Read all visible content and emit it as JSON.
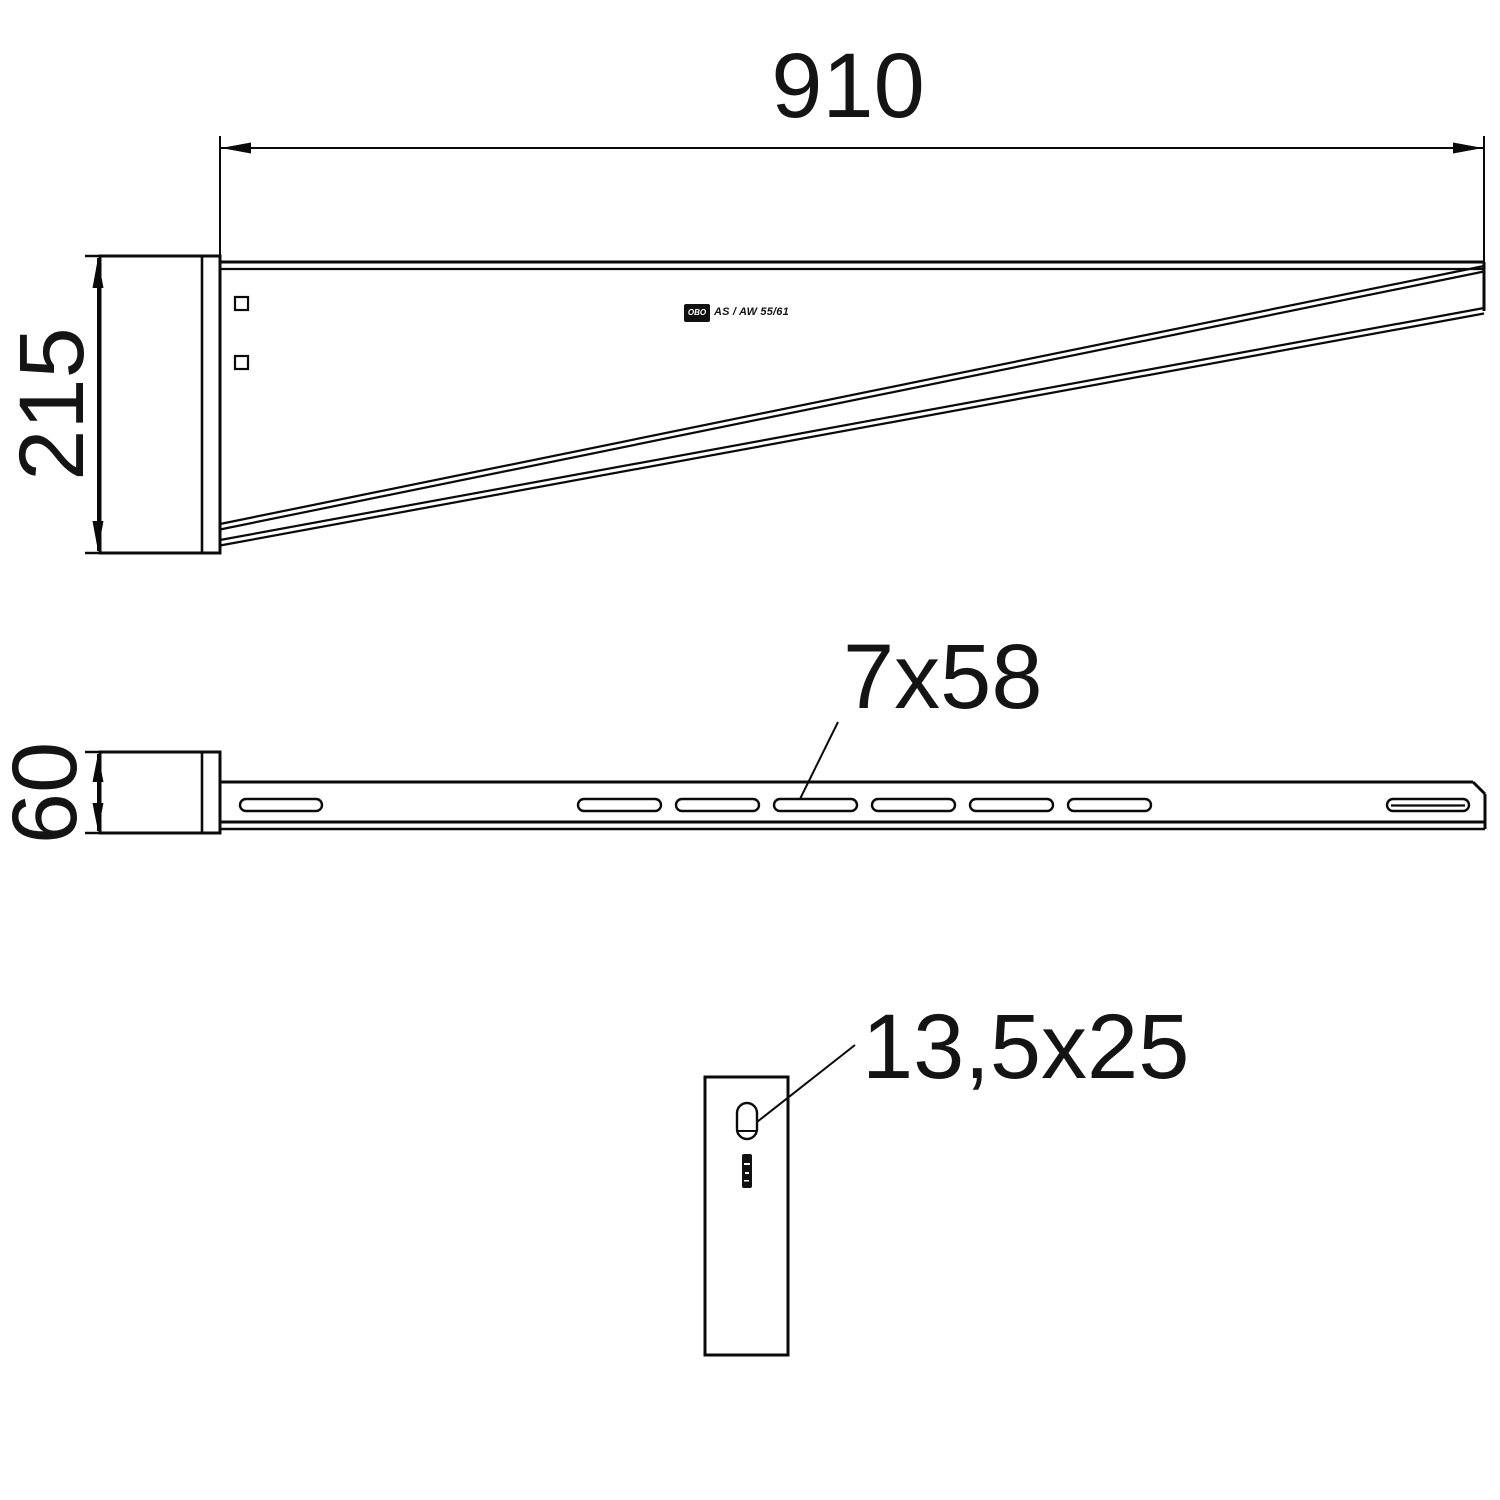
{
  "drawing": {
    "background": "#ffffff",
    "line_color": "#0a0a0a",
    "views": {
      "side_elevation": {
        "dim_overall_length": "910",
        "dim_height": "215",
        "stamp_logo": "OBO",
        "stamp_product": "AS / AW 55/61"
      },
      "plan_view": {
        "dim_arm_width": "60",
        "slot_label": "7x58",
        "slot_count_arm": 8
      },
      "end_view": {
        "slot_label": "13,5x25"
      }
    }
  }
}
